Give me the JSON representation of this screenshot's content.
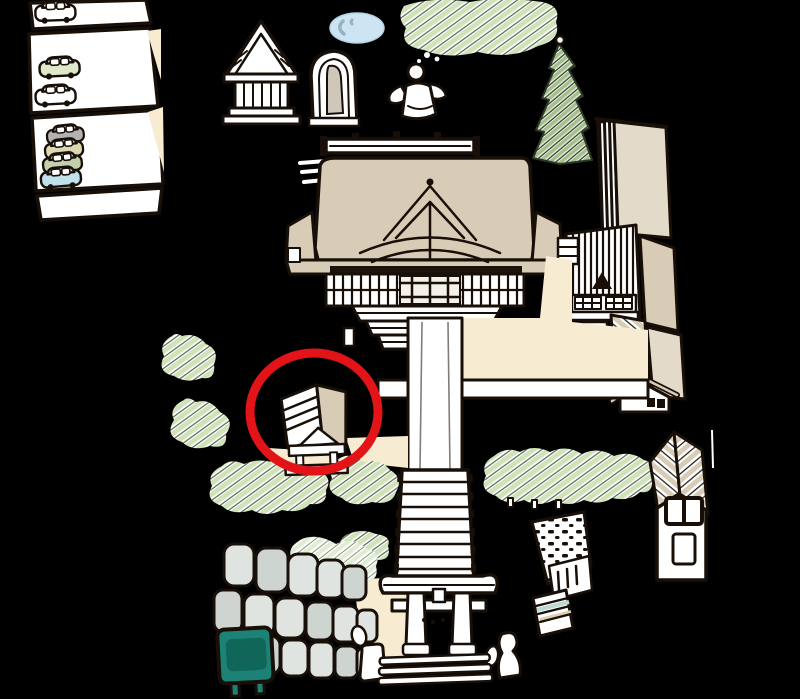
{
  "map": {
    "type": "hand-drawn illustrated shrine grounds map",
    "annotation": {
      "shape": "ellipse",
      "purpose": "highlight circled building",
      "center_x": 314,
      "center_y": 412,
      "radius_x": 64,
      "radius_y": 59,
      "stroke_width": 9
    },
    "features": [
      {
        "name": "parking-lot",
        "cars_visible": 7
      },
      {
        "name": "hokora-small-shrine"
      },
      {
        "name": "stone-monument"
      },
      {
        "name": "pond"
      },
      {
        "name": "statue"
      },
      {
        "name": "tree-canopy"
      },
      {
        "name": "conifer-tree"
      },
      {
        "name": "shrine-office-complex"
      },
      {
        "name": "main-hall"
      },
      {
        "name": "courtyard"
      },
      {
        "name": "approach-path"
      },
      {
        "name": "side-path"
      },
      {
        "name": "stone-stairs"
      },
      {
        "name": "side-stairs-with-dotted-wall"
      },
      {
        "name": "torii-gate"
      },
      {
        "name": "guardian-statues",
        "count": 2
      },
      {
        "name": "stone-wall"
      },
      {
        "name": "notice-sign-teal"
      },
      {
        "name": "roofed-kiosk",
        "highlighted": true
      },
      {
        "name": "hedge"
      },
      {
        "name": "small-house"
      },
      {
        "name": "trees-and-bushes"
      }
    ]
  },
  "colors": {
    "background": "#000000",
    "ink": "#181008",
    "paper": "#ffffff",
    "roof_tan": "#d8ccb7",
    "roof_tan_light": "#e4dac9",
    "cream": "#f7ebd1",
    "leaf_green": "#cfe2b8",
    "leaf_green_light": "#e0ecd4",
    "leaf_dark": "#47573c",
    "conifer_green": "#a3bf8d",
    "conifer_dark": "#2c3826",
    "pond_blue": "#cde4f2",
    "pond_shadow": "#97b2c6",
    "highlight_red": "#e31418",
    "sign_teal": "#1d8276",
    "sign_teal_dark": "#0f6156",
    "stone_gray": "#e0e4e1",
    "stone_gray_dark": "#ced4d0",
    "statue_tan": "#cfc7ba",
    "car_white": "#ffffff",
    "car_gray": "#b2b2b2",
    "car_beige": "#ded8b2",
    "car_sage": "#c3cfad",
    "car_blue": "#c0e0ea",
    "car_pale_green": "#dfe8c9",
    "step_teal": "#bcd8d0",
    "step_tan": "#ddd0b2"
  }
}
